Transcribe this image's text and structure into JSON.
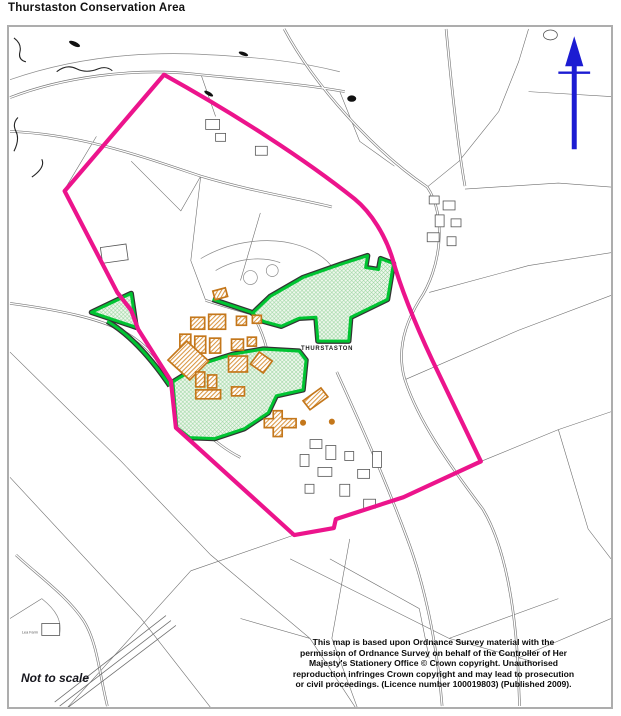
{
  "page": {
    "title": "Thurstaston Conservation Area"
  },
  "map": {
    "labels": {
      "place": "THURSTASTON",
      "farm": "Lea Farm"
    },
    "scale_note": "Not to scale",
    "copyright": {
      "lines": [
        "This map is based upon Ordnance Survey material with the",
        "permission of Ordnance Survey on behalf of the Controller of Her",
        "Majesty's Stationery Office © Crown copyright. Unauthorised",
        "reproduction infringes Crown copyright and may lead to prosecution",
        "or civil proceedings. (Licence number 100019803) (Published 2009)."
      ]
    },
    "icons": {
      "north_arrow": "north-arrow-icon"
    },
    "colors": {
      "boundary_pink": "#EC148C",
      "open_space_green": "#00C432",
      "open_space_fill": "#F0F8EE",
      "building_orange": "#C4771B",
      "north_arrow_blue": "#1C1CD2",
      "road_gray": "#7A7A7A",
      "frame_gray": "#ADADAD"
    }
  }
}
